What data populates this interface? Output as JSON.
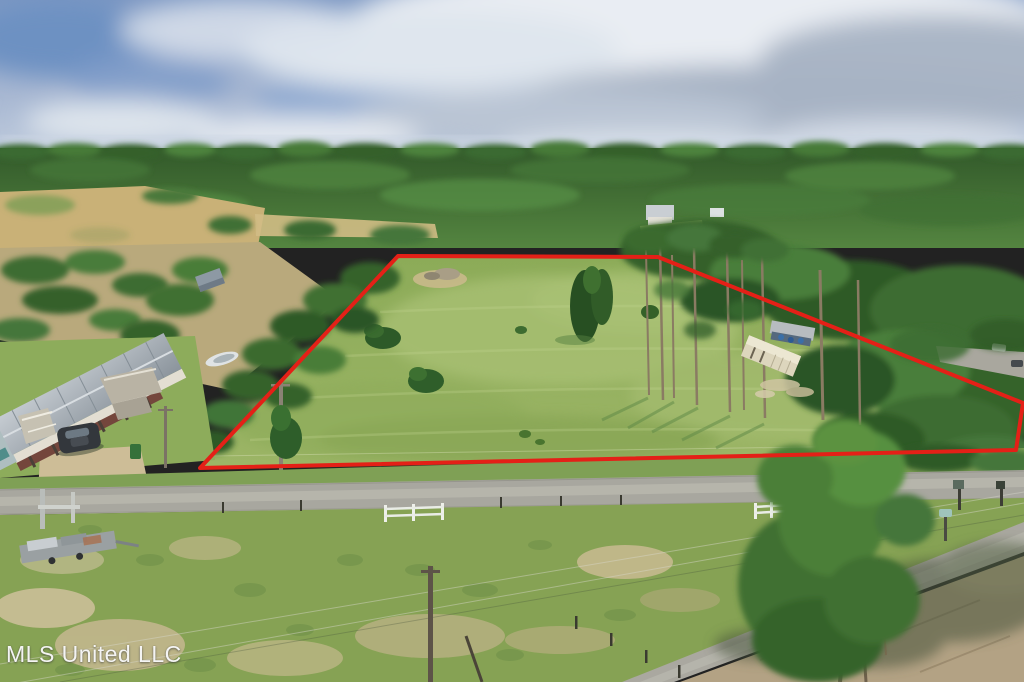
{
  "watermark": {
    "text": "MLS United LLC",
    "color": "#ffffff"
  },
  "boundary": {
    "points": "398,256 658,257 1023,403 1016,450 200,468",
    "color": "#e42017",
    "stroke_width": 4
  },
  "scene": {
    "description": "Aerial drone photograph of a cleared grassy parcel outlined with a red property boundary, ringed by pine forest under a partly cloudy sky, with a stilted house, parked SUV, storage container, rural roads and utility poles",
    "colors": {
      "sky_top": "#7d98c3",
      "sky_horizon": "#c6d1e0",
      "cloud_white": "#ebeff4",
      "cloud_gray": "#a7b3c4",
      "forest_green": "#3c682f",
      "lot_green": "#93b061",
      "field_green": "#86a254",
      "pasture_tan": "#c9b177",
      "dirt_tan": "#b3a284",
      "road_gray": "#a8a79f"
    },
    "objects": [
      "cloudy-sky",
      "far-treeline",
      "left-pasture",
      "boundary-polygon",
      "lot-grass",
      "stilted-house",
      "white-shed",
      "boat",
      "suv",
      "green-bin",
      "utility-poles",
      "storage-container",
      "metal-canopy",
      "pine-trees",
      "right-road",
      "main-road",
      "white-fences",
      "equipment-trailer",
      "mailbox",
      "foreground-tree",
      "diagonal-road",
      "dirt-area",
      "watermark"
    ]
  }
}
